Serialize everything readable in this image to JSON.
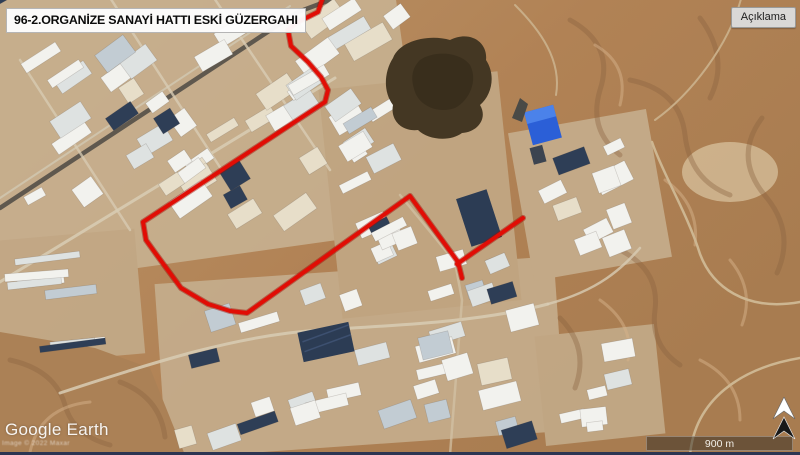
{
  "header": {
    "title": "96-2.ORGANİZE SANAYİ HATTI ESKİ GÜZERGAHI"
  },
  "controls": {
    "legend_button_label": "Açıklama"
  },
  "attribution": {
    "brand": "Google Earth",
    "copyright": "Image © 2022 Maxar"
  },
  "map": {
    "scale_label": "900 m",
    "route": {
      "name": "96-2 organize sanayi hatti eski guzergahi",
      "color": "#e10d05",
      "main_points": [
        [
          322,
          0
        ],
        [
          318,
          12
        ],
        [
          296,
          23
        ],
        [
          288,
          30
        ],
        [
          291,
          46
        ],
        [
          308,
          62
        ],
        [
          321,
          77
        ],
        [
          328,
          90
        ],
        [
          325,
          102
        ],
        [
          143,
          222
        ],
        [
          146,
          240
        ],
        [
          156,
          254
        ],
        [
          181,
          288
        ],
        [
          208,
          304
        ],
        [
          230,
          311
        ],
        [
          247,
          313
        ],
        [
          410,
          196
        ],
        [
          458,
          262
        ],
        [
          462,
          278
        ]
      ],
      "branch_points": [
        [
          457,
          264
        ],
        [
          523,
          218
        ]
      ]
    }
  }
}
